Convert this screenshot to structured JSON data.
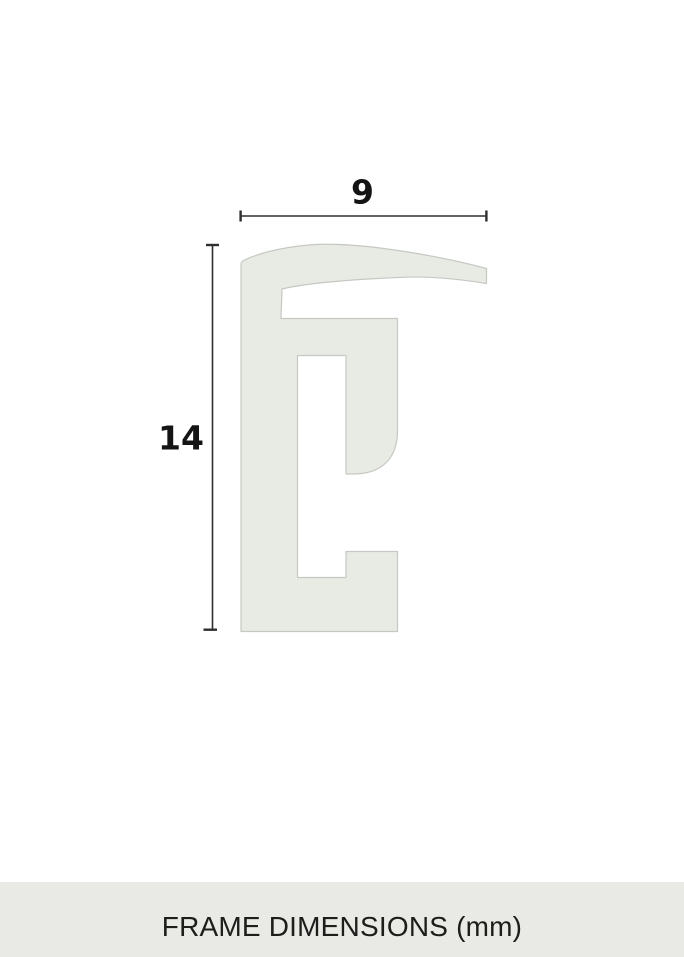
{
  "diagram": {
    "width_dimension": {
      "value": "9"
    },
    "height_dimension": {
      "value": "14"
    }
  },
  "footer": {
    "title": "FRAME DIMENSIONS (mm)"
  },
  "colors": {
    "background": "#ffffff",
    "profile_fill": "#e8eae4",
    "profile_stroke": "#c6c9c3",
    "dimension_line": "#2e2e2e",
    "dimension_text": "#141414",
    "footer_background": "#e9e9e6",
    "footer_text": "#1d1d1b"
  }
}
